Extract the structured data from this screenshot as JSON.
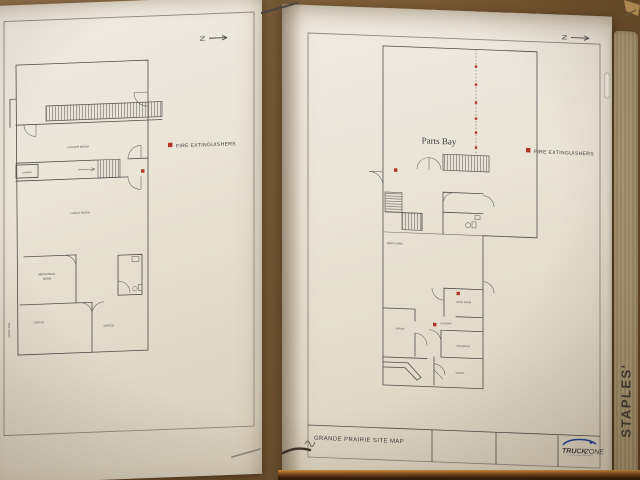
{
  "left_plan": {
    "north_label": "N",
    "legend_label": "FIRE EXTINGUISHERS",
    "rooms": {
      "locker_room": "LOCKER ROOM",
      "landing": "LANDING",
      "lunch_room": "LUNCH ROOM",
      "mechanical_room_line1": "MECHANICAL",
      "mechanical_room_line2": "ROOM",
      "office_left": "OFFICE",
      "office_right": "OFFICE"
    },
    "side_note": "NORTH SIDE"
  },
  "right_plan": {
    "north_label": "N",
    "area_title": "Parts Bay",
    "legend_label": "FIRE EXTINGUISHERS",
    "rooms": {
      "parts_area": "PARTS AREA",
      "back_room": "BACK ROOM",
      "hallway": "HALLWAY",
      "office": "OFFICE",
      "washroom": "WASHROOM",
      "office_lower": "OFFICE"
    },
    "title_block": {
      "title": "GRANDE PRAIRIE SITE MAP"
    },
    "logo": {
      "word1": "TRUCK",
      "word2": "ZONE"
    }
  },
  "sleeve": {
    "brand": "STAPLES'"
  },
  "colors": {
    "fire_marker": "#b23327",
    "logo_blue": "#16316e",
    "logo_green": "#8fa94a"
  }
}
